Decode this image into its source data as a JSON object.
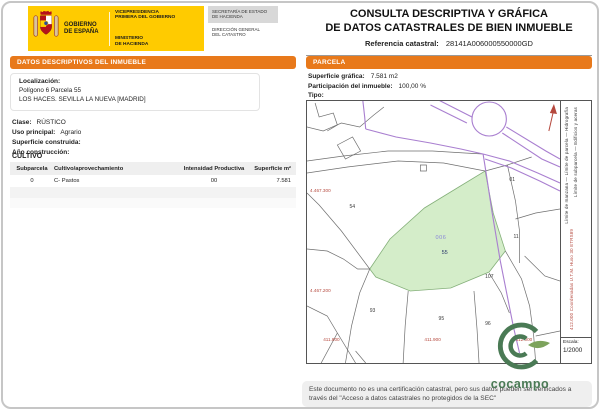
{
  "colors": {
    "accent_orange": "#E8791B",
    "gov_yellow": "#FFCB00",
    "highlight_green_fill": "#D4EDC9",
    "road_purple": "#A97FD0",
    "coordinate_red": "#B5483D",
    "cocampo_green": "#4A7A55"
  },
  "header": {
    "gobierno": "GOBIERNO\nDE ESPAÑA",
    "vicepresidencia": "VICEPRESIDENCIA\nPRIMERA DEL GOBIERNO",
    "ministerio": "MINISTERIO\nDE HACIENDA",
    "secretaria": "SECRETARÍA DE ESTADO\nDE HACIENDA",
    "direccion": "DIRECCIÓN GENERAL\nDEL CATASTRO",
    "title_line1": "CONSULTA DESCRIPTIVA Y GRÁFICA",
    "title_line2": "DE DATOS CATASTRALES DE BIEN INMUEBLE",
    "ref_label": "Referencia catastral:",
    "ref_value": "28141A006000550000GD"
  },
  "inmueble": {
    "section_title": "DATOS DESCRIPTIVOS DEL INMUEBLE",
    "localizacion_label": "Localización:",
    "localizacion_line1": "Polígono 6 Parcela 55",
    "localizacion_line2": "LOS HACES. SEVILLA LA NUEVA [MADRID]",
    "clase_label": "Clase:",
    "clase_value": "RÚSTICO",
    "uso_label": "Uso principal:",
    "uso_value": "Agrario",
    "superficie_label": "Superficie construida:",
    "anio_label": "Año construcción:",
    "cultivo_title": "CULTIVO",
    "cultivo": {
      "headers": [
        "Subparcela",
        "Cultivo/aprovechamiento",
        "Intensidad Productiva",
        "Superficie m²"
      ],
      "rows": [
        [
          "0",
          "C- Pastos",
          "00",
          "7.581"
        ]
      ]
    }
  },
  "parcela": {
    "section_title": "PARCELA",
    "superficie_label": "Superficie gráfica:",
    "superficie_value": "7.581 m2",
    "participacion_label": "Participación del inmueble:",
    "participacion_value": "100,00 %",
    "tipo_label": "Tipo:",
    "map": {
      "highlight_code": "006",
      "highlight_parcel": "55",
      "labels": {
        "p54": "54",
        "p01": "01",
        "p11": "11",
        "p107": "107",
        "p93": "93",
        "p95": "95",
        "p96": "96"
      },
      "coord_left_top": "4.467.300",
      "coord_left_bottom": "4.467.200",
      "coord_bottom_1": "411.800",
      "coord_bottom_2": "411.900",
      "coord_bottom_3": "412.000",
      "legend_col1": "Límite de manzana — Límite de parcela — Hidrografía",
      "legend_col2": "Límite de subparcela — Edificios y aceras",
      "legend_red": "412.000 Coordenadas U.T.M. Huso 30 ETRS89",
      "escala_label": "Escala:",
      "escala_value": "1/2000"
    }
  },
  "branding": {
    "logo_text": "cocampo"
  },
  "footer": {
    "note": "Este documento no es una certificación catastral, pero sus datos pueden ser verificados a través del \"Acceso a datos catastrales no protegidos de la SEC\""
  }
}
